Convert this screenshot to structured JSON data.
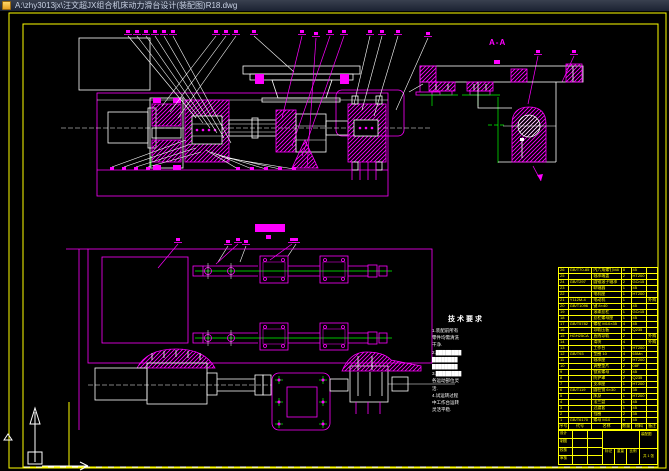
{
  "window": {
    "title": "A:\\zhy3013jx\\汪文超JX组合机床动力滑台设计(装配图)R18.dwg",
    "icon": "dwg-file-icon"
  },
  "colors": {
    "line_magenta": "#FF00FF",
    "line_white": "#FFFFFF",
    "line_green": "#00FF00",
    "frame_yellow": "#FFFF00",
    "background": "#000000",
    "titlebar": "#1B2232"
  },
  "drawing": {
    "section_label": "A-A",
    "tech_requirements": {
      "title": "技术要求",
      "items": [
        "1.装配前所有",
        "零件均需清洗",
        "干净.",
        "2.████████",
        "████████",
        "████████",
        "3.████████",
        "各运动部位灵",
        "活.",
        "4.试运转过程",
        "中工作台运转",
        "灵活平稳."
      ]
    }
  },
  "bom": {
    "headers": [
      "序号",
      "代号",
      "名称",
      "数量",
      "材料",
      "备注"
    ],
    "rows": [
      [
        "26",
        "GB/T70-85",
        "内六角螺钉M8",
        "8",
        "45",
        ""
      ],
      [
        "25",
        "",
        "轴承端盖",
        "2",
        "HT200",
        ""
      ],
      [
        "24",
        "GB/T297",
        "圆锥滚子轴承",
        "2",
        "GCr15",
        ""
      ],
      [
        "23",
        "",
        "联轴器",
        "1",
        "45",
        ""
      ],
      [
        "22",
        "",
        "电机座",
        "1",
        "HT200",
        ""
      ],
      [
        "21",
        "Y112M-4",
        "电动机",
        "1",
        "",
        "外购"
      ],
      [
        "20",
        "GB/T1096",
        "键 8×40",
        "1",
        "45",
        ""
      ],
      [
        "19",
        "",
        "滚珠丝杠",
        "1",
        "GCr15",
        ""
      ],
      [
        "18",
        "",
        "丝杠螺母座",
        "1",
        "45",
        ""
      ],
      [
        "17",
        "GB/T5782",
        "螺栓 M10×35",
        "4",
        "45",
        ""
      ],
      [
        "16",
        "",
        "导轨压板",
        "4",
        "Q235",
        ""
      ],
      [
        "15",
        "HGH25CA",
        "直线导轨",
        "2",
        "",
        "外购"
      ],
      [
        "14",
        "",
        "滑块",
        "4",
        "",
        "外购"
      ],
      [
        "13",
        "",
        "工作台",
        "1",
        "HT200",
        ""
      ],
      [
        "12",
        "GB/T93",
        "垫圈 10",
        "4",
        "65Mn",
        ""
      ],
      [
        "11",
        "",
        "轴承座",
        "2",
        "HT200",
        ""
      ],
      [
        "10",
        "",
        "调整垫片",
        "2",
        "08F",
        ""
      ],
      [
        "9",
        "",
        "锁紧螺母",
        "2",
        "45",
        ""
      ],
      [
        "8",
        "",
        "防护罩",
        "2",
        "Q235",
        ""
      ],
      [
        "7",
        "",
        "支承座",
        "1",
        "HT200",
        ""
      ],
      [
        "6",
        "GB/T119",
        "圆柱销 6×30",
        "4",
        "35",
        ""
      ],
      [
        "5",
        "",
        "床身",
        "1",
        "HT200",
        ""
      ],
      [
        "4",
        "",
        "法兰盘",
        "1",
        "45",
        ""
      ],
      [
        "3",
        "",
        "过渡套",
        "1",
        "45",
        ""
      ],
      [
        "2",
        "",
        "挡圈",
        "2",
        "35",
        ""
      ],
      [
        "1",
        "GB/T6170",
        "螺母 M10",
        "4",
        "45",
        ""
      ]
    ]
  },
  "title_block": {
    "left_labels": [
      "设计",
      "制图",
      "校核",
      "审核"
    ],
    "mid_labels": [
      "标记",
      "重量",
      "比例"
    ],
    "right_top": "装配图",
    "right_bottom": "共 1 张"
  }
}
